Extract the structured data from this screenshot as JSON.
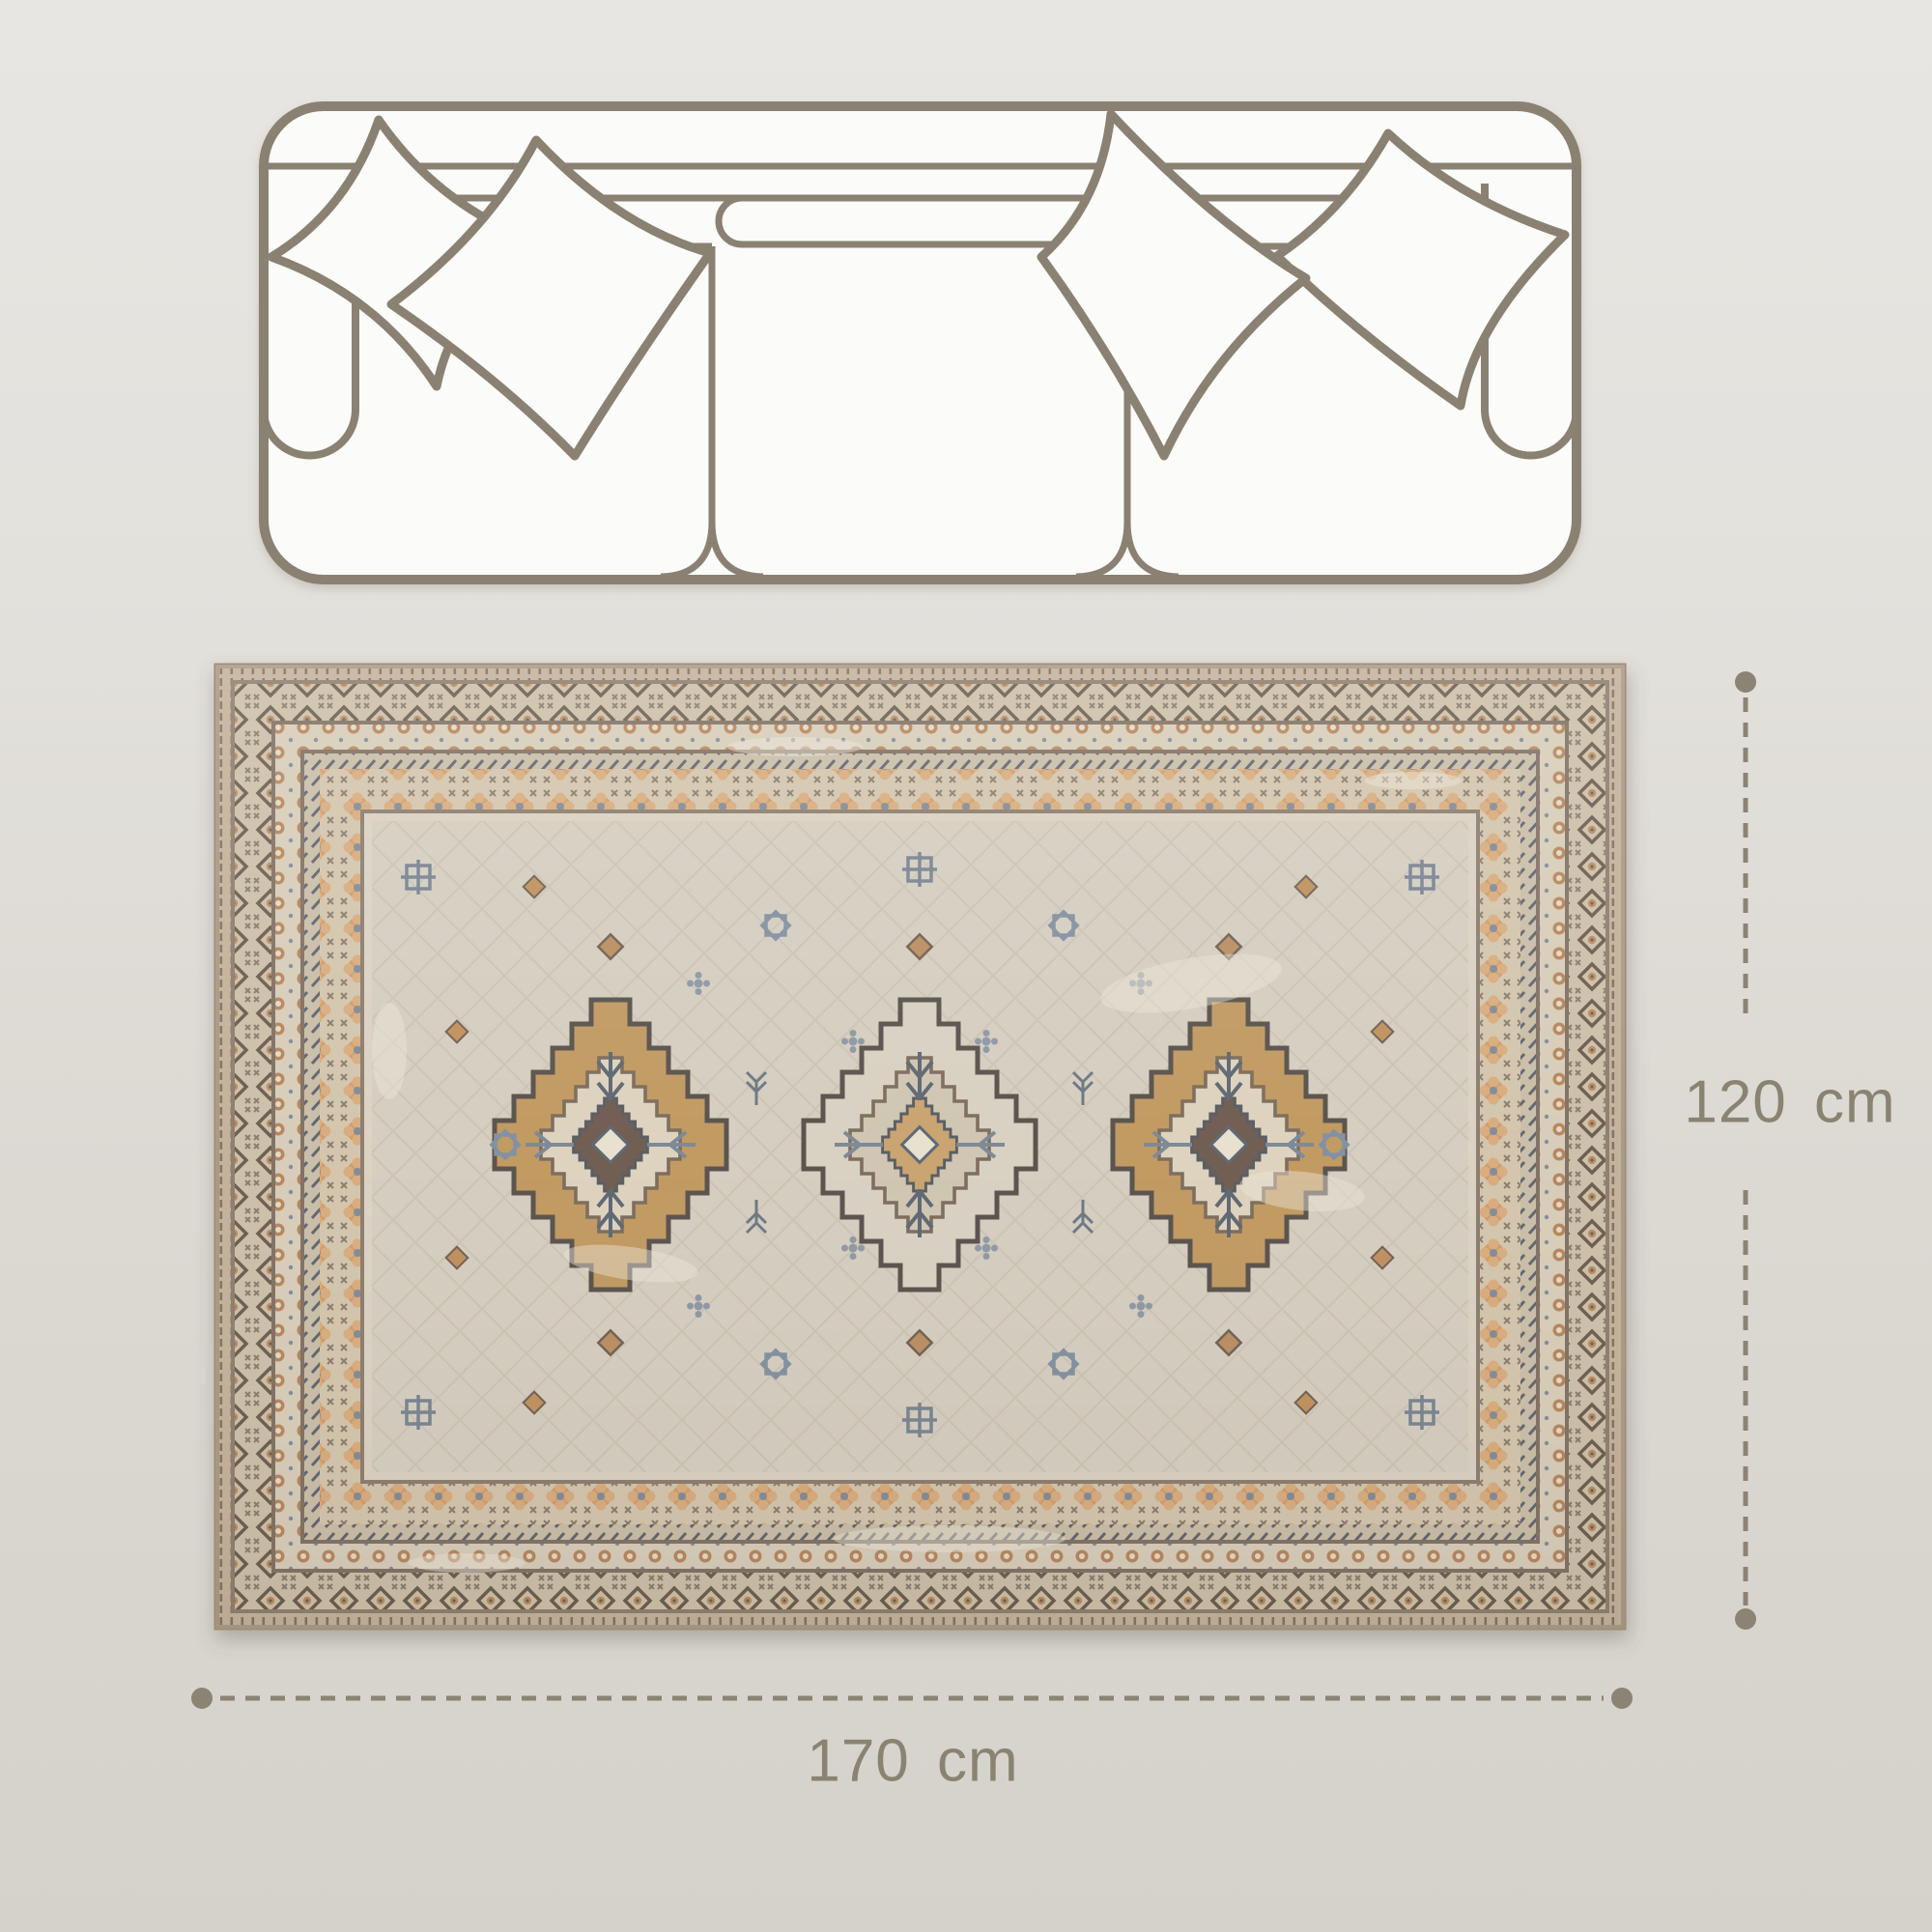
{
  "page": {
    "background_top": "#e8e6e2",
    "background_bottom": "#d5d2cb"
  },
  "illustration": {
    "sofa": {
      "line_color": "#8a8172",
      "fill_color": "#fbfbf9",
      "pillow_count": 4,
      "seat_count": 3
    },
    "rug": {
      "field_color": "#d4cdbf",
      "border_background": "#cbbfa8",
      "accent_tan": "#c0985f",
      "accent_orange": "#cf9b69",
      "accent_blue": "#7e8a96",
      "outline_color": "#6f5e4f",
      "medallion_count": 3
    }
  },
  "dimensions": {
    "line_color": "#8b8374",
    "text_color": "#8a8372",
    "width": {
      "label": "170 cm"
    },
    "height": {
      "label": "120 cm"
    }
  }
}
